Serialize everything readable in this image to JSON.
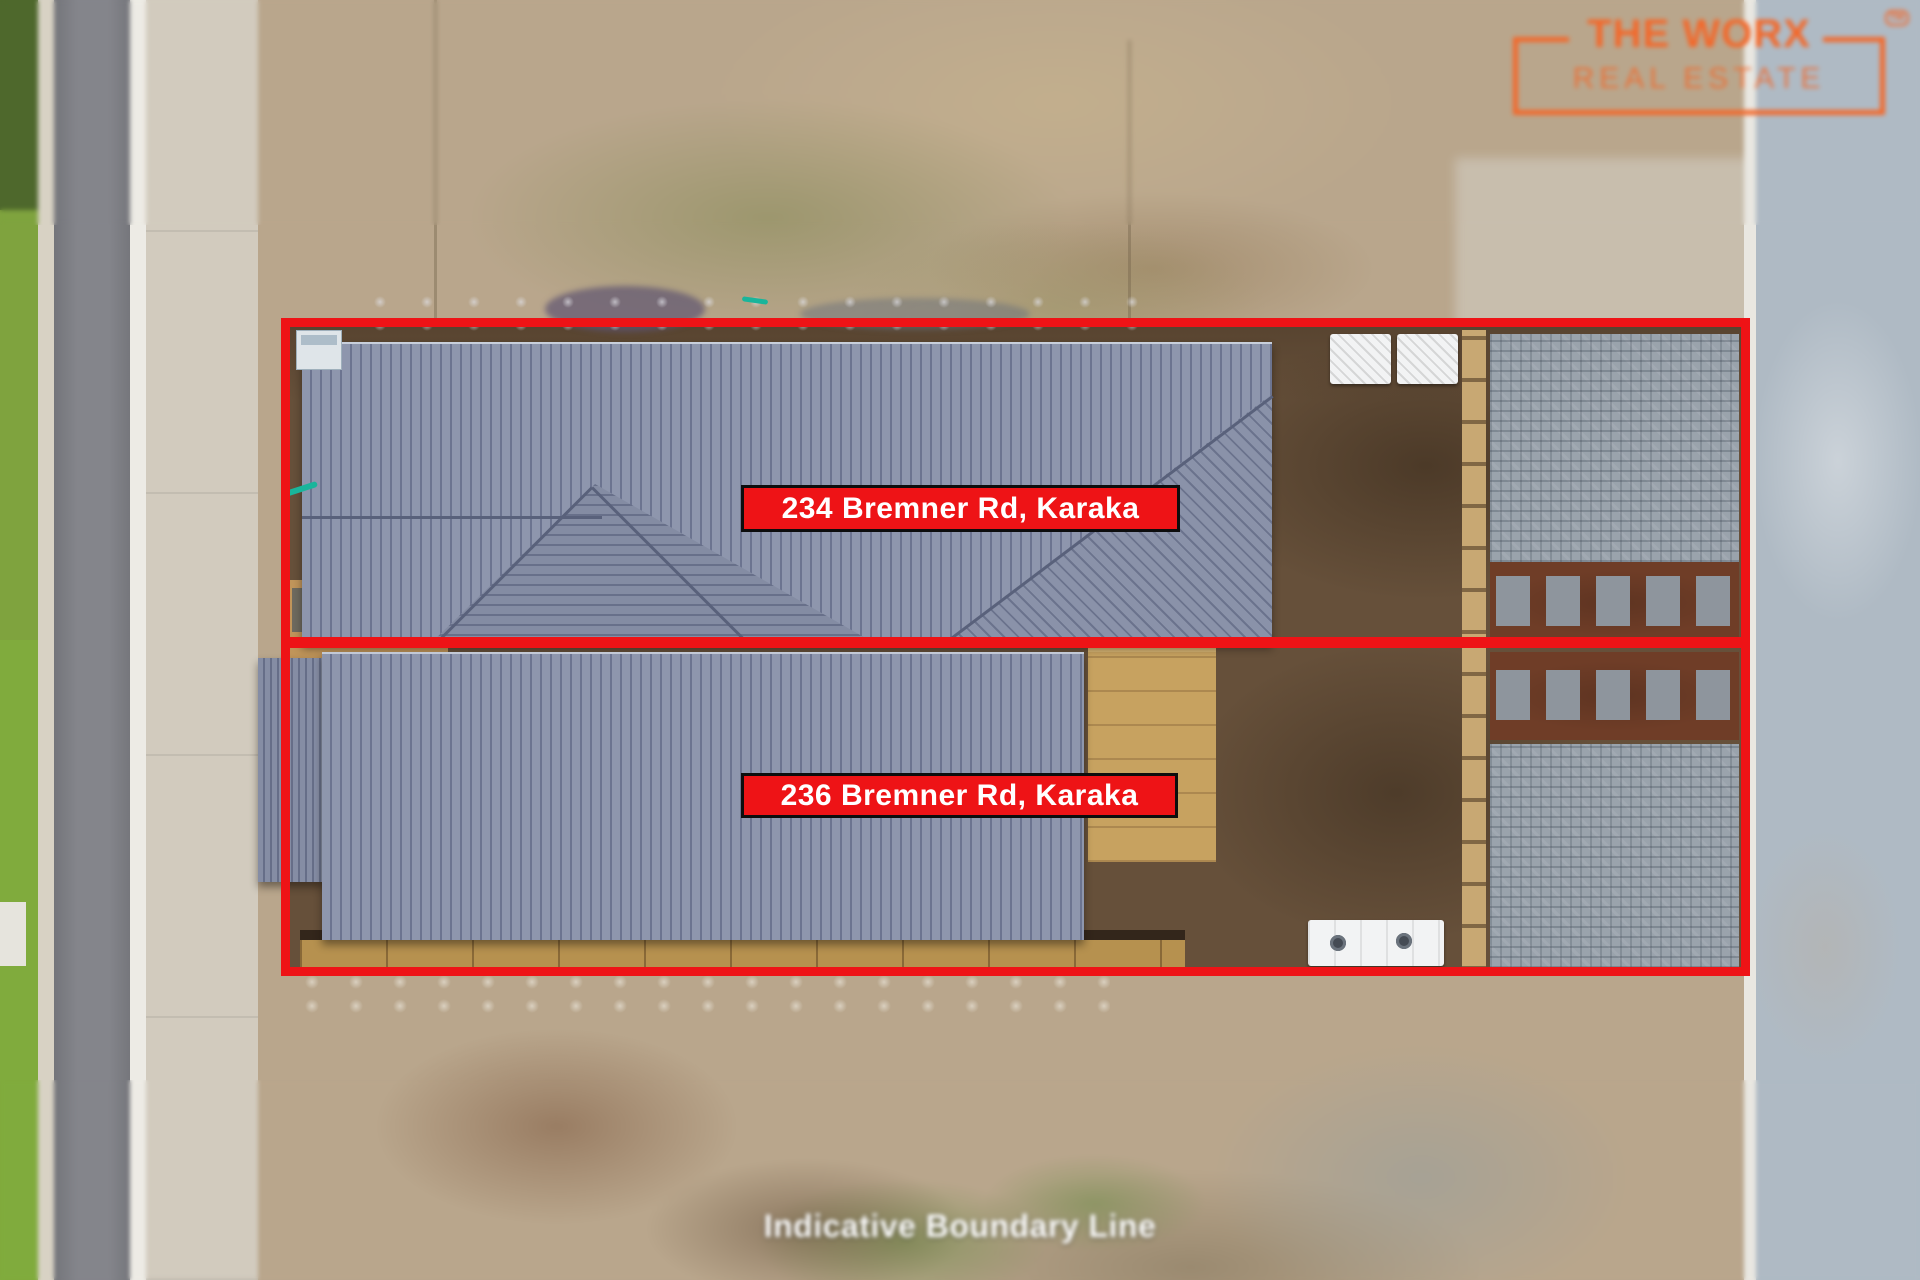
{
  "page": {
    "caption": "Indicative Boundary Line"
  },
  "logo": {
    "title": "THE WORX",
    "subtitle": "REAL ESTATE",
    "trademark": "TM",
    "accent_color": "#F3682A"
  },
  "properties": [
    {
      "label": "234 Bremner Rd, Karaka"
    },
    {
      "label": "236 Bremner Rd, Karaka"
    }
  ],
  "colors": {
    "boundary_red": "#EE1316",
    "label_background": "#EE1316",
    "label_border": "#0D0D0D",
    "label_text": "#FFFFFF",
    "caption_text": "#FFFFFF",
    "roof_gray": "#8E96AD",
    "dirt_brown": "#66503A"
  }
}
